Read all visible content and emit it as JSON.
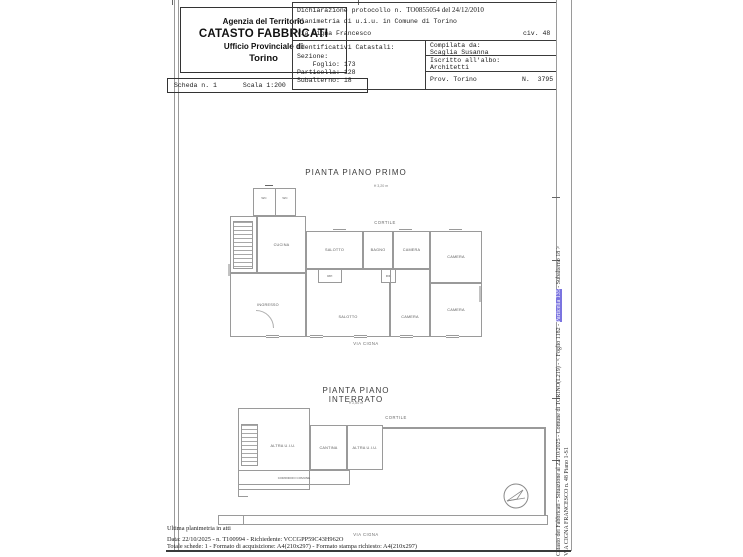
{
  "header": {
    "agency": {
      "line1": "Agenzia del Territorio",
      "line2": "CATASTO FABBRICATI",
      "line3": "Ufficio Provinciale di",
      "line4": "Torino"
    },
    "scheda": {
      "scheda_label": "Scheda n. 1",
      "scala_label": "Scala 1:200"
    },
    "declaration": {
      "prefix": "Dichiarazione protocollo n. ",
      "protocol": "TO0855054",
      "del": " del ",
      "date": "24/12/2010",
      "line2": "Planimetria di u.i.u. in Comune di Torino",
      "street": "Via Cigna Francesco",
      "civ": "civ. 48"
    },
    "identificativi": {
      "title": "Identificativi Catastali:",
      "sezione_label": "   Sezione:",
      "foglio_label": "    Foglio: ",
      "foglio": "173",
      "particella_label": "Particella: ",
      "particella": "128",
      "subalterno_label": "Subalterno: ",
      "subalterno": "18"
    },
    "compilata": {
      "label": "Compilata da:",
      "name": "Scaglia Susanna",
      "albo_label": "Iscritto all'albo:",
      "albo": "Architetti",
      "prov_label": "Prov. ",
      "prov": "Torino",
      "n_label": "N.  ",
      "n": "3795"
    }
  },
  "plans": {
    "primo": {
      "title": "PIANTA PIANO PRIMO",
      "height": "H 3,20 m",
      "cortile": "CORTILE",
      "street": "VIA CIGNA",
      "rooms": {
        "wc1": "WC",
        "wc2": "WC",
        "cucina": "CUCINA",
        "ingresso": "INGRESSO",
        "salotto_top": "SALOTTO",
        "bagno": "BAGNO",
        "camera_top": "CAMERA",
        "camera_right": "CAMERA",
        "rip1": "RIP.",
        "rip2": "RIP.",
        "salotto_bottom": "SALOTTO",
        "camera_b1": "CAMERA",
        "camera_b2": "CAMERA"
      }
    },
    "interrato": {
      "title": "PIANTA PIANO INTERRATO",
      "height": "H 2,80 m",
      "cortile": "CORTILE",
      "street": "VIA CIGNA",
      "rooms": {
        "altra1": "ALTRA U.I.U.",
        "cantina": "CANTINA",
        "altra2": "ALTRA U.I.U.",
        "corridoio": "CORRIDOIO COMUNE"
      }
    }
  },
  "footer": {
    "line1": "Ultima planimetria in atti",
    "line2": "Data: 22/10/2025 - n. T100994 - Richiedente: VCCGPP59C43H962O",
    "line3": "Totale schede: 1 - Formato di acquisizione: A4(210x297) - Formato stampa richiesto: A4(210x297)"
  },
  "sidebar": {
    "line1_pre": "Catasto dei Fabbricati - Situazione al 22/10/2025 - Comune di TORINO(L219) - < Foglio 1182 - ",
    "line1_highlight": "Particella 135",
    "line1_post": " - Subalterno 18 >",
    "line2": "VIA CIGNA FRANCESCO n. 48 Piano 1-S1",
    "highlight_color": "#7b74e0"
  }
}
